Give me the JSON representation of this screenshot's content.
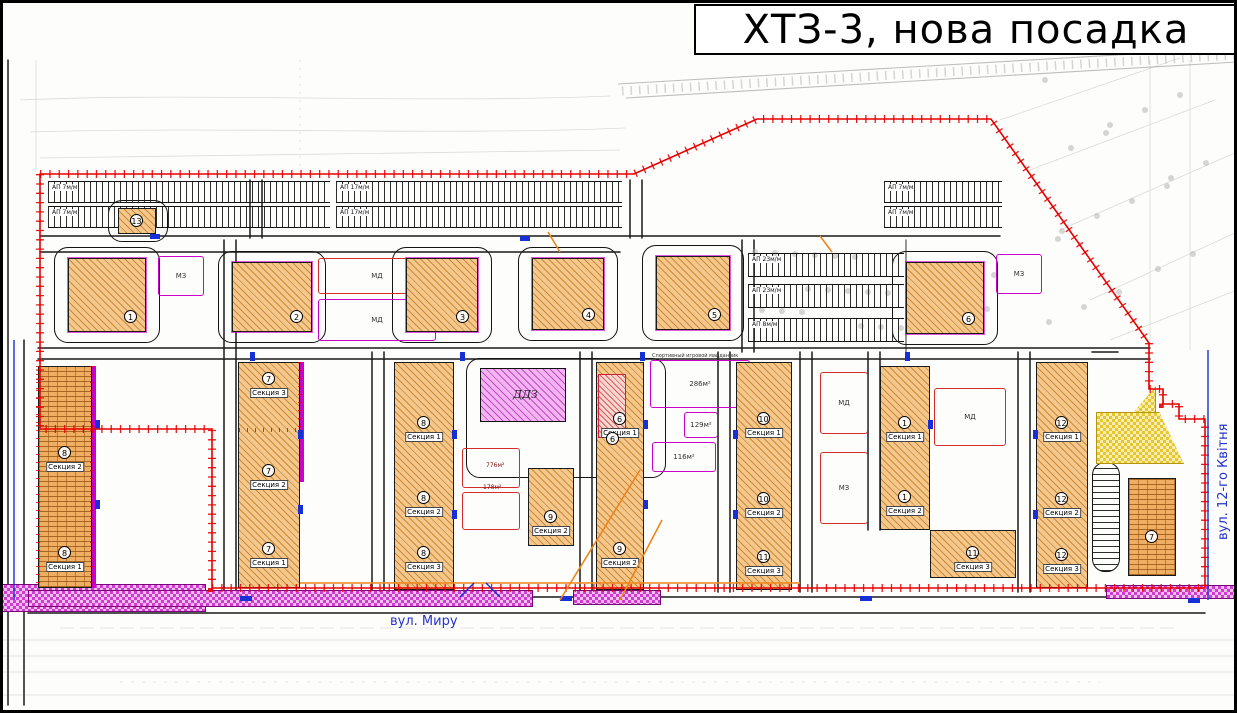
{
  "title": "ХТЗ-3, нова посадка",
  "streets": {
    "bottom": "вул. Миру",
    "right": "вул. 12-го Квітня"
  },
  "notes": {
    "sport": "Спортивный игровой майданчик"
  },
  "daycare": {
    "label": "ДДЗ",
    "x": 480,
    "y": 368,
    "w": 86,
    "h": 54
  },
  "substation": {
    "number": "13",
    "x": 118,
    "y": 208,
    "w": 38,
    "h": 26
  },
  "overlay_building": {
    "number": "6",
    "x": 598,
    "y": 374,
    "w": 28,
    "h": 64
  },
  "square_buildings": [
    {
      "num": "1",
      "x": 68,
      "y": 258,
      "w": 78,
      "h": 74
    },
    {
      "num": "2",
      "x": 232,
      "y": 262,
      "w": 80,
      "h": 70
    },
    {
      "num": "3",
      "x": 406,
      "y": 258,
      "w": 72,
      "h": 74
    },
    {
      "num": "4",
      "x": 532,
      "y": 258,
      "w": 72,
      "h": 72
    },
    {
      "num": "5",
      "x": 656,
      "y": 256,
      "w": 74,
      "h": 74
    },
    {
      "num": "6",
      "x": 906,
      "y": 262,
      "w": 78,
      "h": 72
    }
  ],
  "section_buildings": [
    {
      "hatch": "brick",
      "x": 38,
      "y": 366,
      "w": 54,
      "h": 222,
      "sections": [
        {
          "num": "8",
          "label": "Секция 2",
          "ly": 96
        },
        {
          "num": "8",
          "label": "Секция 1",
          "ly": 196
        }
      ]
    },
    {
      "hatch": "diag",
      "x": 238,
      "y": 362,
      "w": 62,
      "h": 226,
      "sections": [
        {
          "num": "7",
          "label": "Секция 3",
          "ly": 26
        },
        {
          "num": "7",
          "label": "Секция 2",
          "ly": 118
        },
        {
          "num": "7",
          "label": "Секция 1",
          "ly": 196
        }
      ]
    },
    {
      "hatch": "diag",
      "x": 394,
      "y": 362,
      "w": 60,
      "h": 228,
      "sections": [
        {
          "num": "8",
          "label": "Секция 1",
          "ly": 70
        },
        {
          "num": "8",
          "label": "Секция 2",
          "ly": 145
        },
        {
          "num": "8",
          "label": "Секция 3",
          "ly": 200
        }
      ]
    },
    {
      "hatch": "diag",
      "x": 528,
      "y": 468,
      "w": 46,
      "h": 78,
      "sections": [
        {
          "num": "9",
          "label": "Секция 2",
          "ly": 58
        }
      ]
    },
    {
      "hatch": "diag",
      "x": 596,
      "y": 362,
      "w": 48,
      "h": 228,
      "sections": [
        {
          "num": "6",
          "label": "Секция 1",
          "ly": 66
        },
        {
          "num": "9",
          "label": "Секция 2",
          "ly": 196
        }
      ]
    },
    {
      "hatch": "diag",
      "x": 736,
      "y": 362,
      "w": 56,
      "h": 228,
      "sections": [
        {
          "num": "10",
          "label": "Секция 1",
          "ly": 66
        },
        {
          "num": "10",
          "label": "Секция 2",
          "ly": 146
        },
        {
          "num": "11",
          "label": "Секция 3",
          "ly": 204
        }
      ]
    },
    {
      "hatch": "diag",
      "x": 880,
      "y": 366,
      "w": 50,
      "h": 164,
      "sections": [
        {
          "num": "1",
          "label": "Секция 1",
          "ly": 66
        },
        {
          "num": "1",
          "label": "Секция 2",
          "ly": 140
        }
      ]
    },
    {
      "hatch": "diag",
      "x": 930,
      "y": 530,
      "w": 86,
      "h": 48,
      "sections": [
        {
          "num": "11",
          "label": "Секция 3",
          "ly": 32
        }
      ]
    },
    {
      "hatch": "diag",
      "x": 1036,
      "y": 362,
      "w": 52,
      "h": 226,
      "sections": [
        {
          "num": "12",
          "label": "Секция 1",
          "ly": 70
        },
        {
          "num": "12",
          "label": "Секция 2",
          "ly": 146
        },
        {
          "num": "12",
          "label": "Секция 3",
          "ly": 202
        }
      ]
    },
    {
      "hatch": "brick",
      "x": 1128,
      "y": 478,
      "w": 48,
      "h": 98,
      "sections": [
        {
          "num": "7",
          "label": "",
          "ly": 68
        }
      ]
    }
  ],
  "playgrounds": [
    {
      "label": "МЗ",
      "variant": "magenta",
      "x": 158,
      "y": 256,
      "w": 46,
      "h": 40
    },
    {
      "label": "МД",
      "variant": "red",
      "x": 318,
      "y": 258,
      "w": 118,
      "h": 36
    },
    {
      "label": "МД",
      "variant": "magenta",
      "x": 318,
      "y": 299,
      "w": 118,
      "h": 42
    },
    {
      "label": "МЗ",
      "variant": "magenta",
      "x": 996,
      "y": 254,
      "w": 46,
      "h": 40
    },
    {
      "label": "МД",
      "variant": "red",
      "x": 820,
      "y": 372,
      "w": 48,
      "h": 62
    },
    {
      "label": "МЗ",
      "variant": "red",
      "x": 820,
      "y": 452,
      "w": 48,
      "h": 72
    },
    {
      "label": "МД",
      "variant": "red",
      "x": 934,
      "y": 388,
      "w": 72,
      "h": 58
    },
    {
      "label": "",
      "variant": "red",
      "x": 462,
      "y": 448,
      "w": 58,
      "h": 40
    },
    {
      "label": "",
      "variant": "red",
      "x": 462,
      "y": 492,
      "w": 58,
      "h": 38
    }
  ],
  "sport_areas": [
    {
      "area": "286м²",
      "x": 650,
      "y": 360,
      "w": 100,
      "h": 48
    },
    {
      "area": "129м²",
      "x": 684,
      "y": 412,
      "w": 34,
      "h": 26
    },
    {
      "area": "116м²",
      "x": 652,
      "y": 442,
      "w": 64,
      "h": 30
    }
  ],
  "area_notes": [
    {
      "text": "776м²",
      "x": 486,
      "y": 462
    },
    {
      "text": "178м²",
      "x": 483,
      "y": 484
    }
  ],
  "parking_rows": [
    {
      "label": "АП 7м/м",
      "x": 48,
      "y": 181,
      "w": 282,
      "h": 22
    },
    {
      "label": "АП 7м/м",
      "x": 48,
      "y": 206,
      "w": 282,
      "h": 22
    },
    {
      "label": "АП 17м/м",
      "x": 336,
      "y": 181,
      "w": 286,
      "h": 22
    },
    {
      "label": "АП 17м/м",
      "x": 336,
      "y": 206,
      "w": 286,
      "h": 22
    },
    {
      "label": "АП 7м/м",
      "x": 884,
      "y": 181,
      "w": 118,
      "h": 22
    },
    {
      "label": "АП 7м/м",
      "x": 884,
      "y": 206,
      "w": 118,
      "h": 22
    },
    {
      "label": "АП 23м/м",
      "x": 748,
      "y": 253,
      "w": 156,
      "h": 24
    },
    {
      "label": "АП 23м/м",
      "x": 748,
      "y": 284,
      "w": 156,
      "h": 24
    },
    {
      "label": "АП 8м/м",
      "x": 748,
      "y": 318,
      "w": 156,
      "h": 24
    }
  ],
  "colors": {
    "boundary": "#e60000",
    "road": "#1a1a1a",
    "building_fill": "#f4c88c",
    "building_hatch": "#c07820",
    "daycare_fill": "#f2b5f2",
    "daycare_hatch": "#bb2dbb",
    "playground_outline": "#cc00cc",
    "red_outline": "#d42b2b",
    "street_label": "#2433cc",
    "reserve_yellow": "#e6c62e",
    "utility_orange": "#ef8418"
  }
}
